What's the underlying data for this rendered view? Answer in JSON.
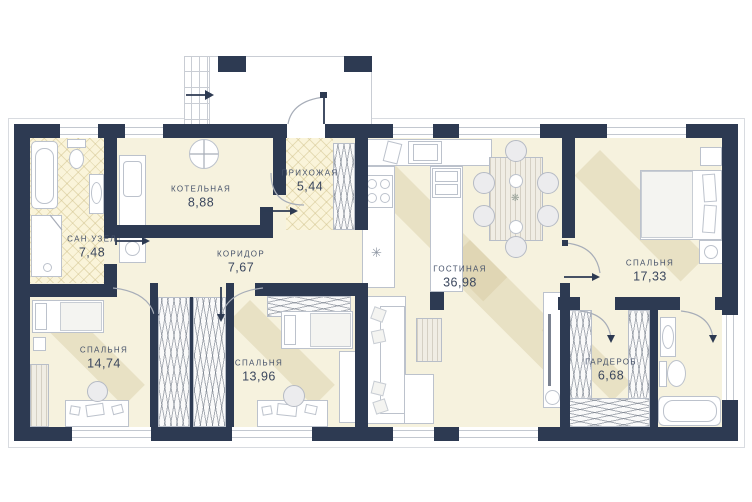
{
  "rooms": [
    {
      "name": "КОТЕЛЬНАЯ",
      "area": "8,88"
    },
    {
      "name": "ПРИХОЖАЯ",
      "area": "5,44"
    },
    {
      "name": "САН.УЗЕЛ",
      "area": "7,48"
    },
    {
      "name": "КОРИДОР",
      "area": "7,67"
    },
    {
      "name": "ГОСТИНАЯ",
      "area": "36,98"
    },
    {
      "name": "СПАЛЬНЯ",
      "area": "17,33"
    },
    {
      "name": "СПАЛЬНЯ",
      "area": "14,74"
    },
    {
      "name": "СПАЛЬНЯ",
      "area": "13,96"
    },
    {
      "name": "ГАРДЕРОБ",
      "area": "6,68"
    }
  ],
  "colors": {
    "wall": "#2d3a52",
    "floor": "#f6f2de",
    "tile": "#faf4da",
    "outline": "#b8bec8"
  }
}
